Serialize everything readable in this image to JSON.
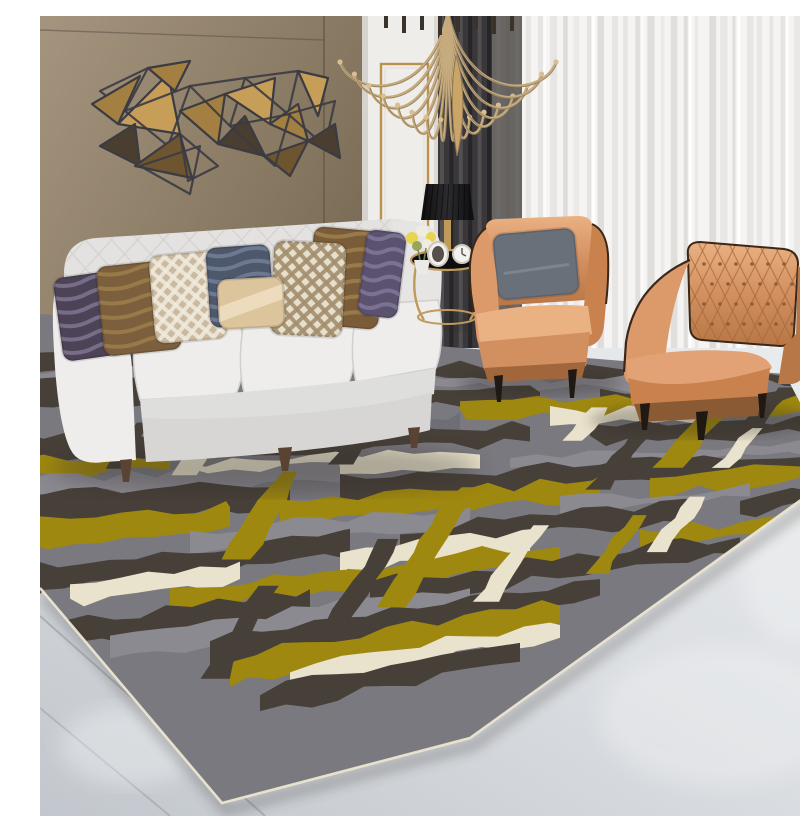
{
  "scene": {
    "description": "modern living room photo: white tufted sofa, two tan leather armchairs, gold geometric wall art on brown wall, sheer curtains, abstract gray-olive-cream area rug on light tile floor",
    "palette": {
      "wall_top": "#9c8d78",
      "wall_bottom": "#6b5d4c",
      "wall_seam": "#5d5246",
      "wall_corner": "#43392e",
      "door_white": "#efedea",
      "door_shadow": "#d6d2ce",
      "gold": "#b8924e",
      "curtain_dark": "#39373a",
      "curtain_dark_fold": "#232225",
      "curtain_dark_lite": "#575456",
      "curtain_gray": "#716d6b",
      "sheer": "#f5f4f2",
      "sheer_fold": "#d2d0ce",
      "sheer_bright": "#ffffff",
      "floor_light": "#e7e9ec",
      "floor_dark": "#c4c9cf",
      "grout": "#a6aaaf",
      "rug_base": "#7a797f",
      "rug_gray2": "#8b8a91",
      "rug_patch": "#6f6e75",
      "rug_dark": "#474039",
      "rug_olive": "#9f880f",
      "rug_cream": "#e9e2cc",
      "rug_edge": "#ece5d0",
      "sofa_body": "#e3e2e1",
      "sofa_lite": "#eeedec",
      "sofa_front": "#dededd",
      "sofa_skirt": "#d7d6d5",
      "sofa_tuft": "#d3d2d1",
      "leg_wood": "#5a4332",
      "leather": "#d08c5c",
      "leather_lite": "#eab183",
      "leather_mid": "#c9824e",
      "leather_dark": "#a2663c",
      "piping": "#3a2718",
      "leg_black": "#1f1813",
      "lamp_black": "#1a191b",
      "metal_gold": "#c09a5a",
      "art_wire": "#3b3b42",
      "art_gold": "#c79e58",
      "art_gold2": "#a37f42",
      "art_bronze": "#6e5530",
      "art_dark": "#4a3e31",
      "shadow": "#2e2b28"
    }
  },
  "chandelier": {
    "cx": 408,
    "arm_count": 16,
    "x_min": 300,
    "x_max": 516,
    "tip_top": 46,
    "tip_drop": 58,
    "candle_count": 8
  },
  "wall_art": {
    "triangles": [
      {
        "p": [
          [
            60,
            75
          ],
          [
            108,
            52
          ],
          [
            85,
            95
          ]
        ],
        "k": "wire"
      },
      {
        "p": [
          [
            52,
            88
          ],
          [
            100,
            60
          ],
          [
            78,
            108
          ]
        ],
        "k": "gold2"
      },
      {
        "p": [
          [
            78,
            108
          ],
          [
            128,
            58
          ],
          [
            140,
            118
          ]
        ],
        "k": "gold"
      },
      {
        "p": [
          [
            85,
            95
          ],
          [
            150,
            70
          ],
          [
            128,
            130
          ]
        ],
        "k": "wire"
      },
      {
        "p": [
          [
            60,
            130
          ],
          [
            95,
            108
          ],
          [
            100,
            150
          ]
        ],
        "k": "dark"
      },
      {
        "p": [
          [
            95,
            150
          ],
          [
            140,
            118
          ],
          [
            152,
            162
          ]
        ],
        "k": "bronze"
      },
      {
        "p": [
          [
            100,
            150
          ],
          [
            160,
            130
          ],
          [
            150,
            178
          ]
        ],
        "k": "wire"
      },
      {
        "p": [
          [
            140,
            95
          ],
          [
            185,
            78
          ],
          [
            178,
            128
          ]
        ],
        "k": "gold2"
      },
      {
        "p": [
          [
            150,
            70
          ],
          [
            205,
            62
          ],
          [
            190,
            110
          ]
        ],
        "k": "wire"
      },
      {
        "p": [
          [
            178,
            128
          ],
          [
            205,
            100
          ],
          [
            225,
            140
          ]
        ],
        "k": "dark"
      },
      {
        "p": [
          [
            185,
            78
          ],
          [
            235,
            62
          ],
          [
            230,
            108
          ]
        ],
        "k": "gold"
      },
      {
        "p": [
          [
            205,
            62
          ],
          [
            258,
            55
          ],
          [
            248,
            98
          ]
        ],
        "k": "wire"
      },
      {
        "p": [
          [
            230,
            108
          ],
          [
            258,
            88
          ],
          [
            268,
            125
          ]
        ],
        "k": "gold2"
      },
      {
        "p": [
          [
            225,
            140
          ],
          [
            268,
            125
          ],
          [
            250,
            160
          ]
        ],
        "k": "bronze"
      },
      {
        "p": [
          [
            190,
            110
          ],
          [
            250,
            98
          ],
          [
            235,
            150
          ]
        ],
        "k": "wire"
      },
      {
        "p": [
          [
            258,
            55
          ],
          [
            288,
            62
          ],
          [
            278,
            100
          ]
        ],
        "k": "gold"
      },
      {
        "p": [
          [
            248,
            98
          ],
          [
            295,
            85
          ],
          [
            285,
            130
          ]
        ],
        "k": "wire"
      },
      {
        "p": [
          [
            268,
            125
          ],
          [
            295,
            108
          ],
          [
            300,
            142
          ]
        ],
        "k": "dark"
      },
      {
        "p": [
          [
            140,
            118
          ],
          [
            178,
            150
          ],
          [
            148,
            165
          ]
        ],
        "k": "wire"
      },
      {
        "p": [
          [
            108,
            52
          ],
          [
            150,
            45
          ],
          [
            135,
            75
          ]
        ],
        "k": "gold2"
      }
    ]
  },
  "rug": {
    "outline": [
      [
        -100,
        290
      ],
      [
        745,
        358
      ],
      [
        797,
        458
      ],
      [
        430,
        722
      ],
      [
        182,
        787
      ],
      [
        0,
        572
      ],
      [
        -100,
        460
      ]
    ],
    "edge_path": [
      [
        797,
        458
      ],
      [
        430,
        722
      ],
      [
        182,
        787
      ],
      [
        0,
        572
      ]
    ],
    "vanish_x": 1733,
    "vanish_y": 384,
    "lean": 0.55,
    "stripes": [
      {
        "y0": 336,
        "y1": 352,
        "c": "rug_dark",
        "segs": [
          [
            -100,
            770
          ]
        ]
      },
      {
        "y0": 352,
        "y1": 366,
        "c": "rug_gray2",
        "segs": [
          [
            -100,
            290
          ],
          [
            380,
            700
          ]
        ]
      },
      {
        "y0": 366,
        "y1": 388,
        "c": "rug_dark",
        "segs": [
          [
            -100,
            170
          ],
          [
            230,
            500
          ],
          [
            560,
            790
          ]
        ]
      },
      {
        "y0": 382,
        "y1": 404,
        "c": "rug_olive",
        "segs": [
          [
            140,
            300
          ],
          [
            420,
            790
          ]
        ]
      },
      {
        "y0": 400,
        "y1": 420,
        "c": "rug_cream",
        "segs": [
          [
            110,
            190
          ],
          [
            510,
            660
          ]
        ]
      },
      {
        "y0": 404,
        "y1": 426,
        "c": "rug_patch",
        "segs": [
          [
            200,
            420
          ]
        ]
      },
      {
        "y0": 420,
        "y1": 444,
        "c": "rug_dark",
        "segs": [
          [
            -100,
            490
          ],
          [
            550,
            800
          ]
        ]
      },
      {
        "y0": 442,
        "y1": 460,
        "c": "rug_olive",
        "segs": [
          [
            -100,
            130
          ]
        ]
      },
      {
        "y0": 452,
        "y1": 472,
        "c": "rug_cream",
        "segs": [
          [
            140,
            440
          ]
        ]
      },
      {
        "y0": 462,
        "y1": 482,
        "c": "rug_gray2",
        "segs": [
          [
            -40,
            300
          ],
          [
            470,
            800
          ]
        ]
      },
      {
        "y0": 480,
        "y1": 506,
        "c": "rug_dark",
        "segs": [
          [
            -100,
            250
          ],
          [
            300,
            810
          ]
        ]
      },
      {
        "y0": 502,
        "y1": 530,
        "c": "rug_olive",
        "segs": [
          [
            -100,
            190
          ],
          [
            240,
            560
          ],
          [
            610,
            815
          ]
        ]
      },
      {
        "y0": 528,
        "y1": 550,
        "c": "rug_gray2",
        "segs": [
          [
            150,
            430
          ],
          [
            520,
            710
          ]
        ]
      },
      {
        "y0": 548,
        "y1": 574,
        "c": "rug_dark",
        "segs": [
          [
            -60,
            310
          ],
          [
            360,
            650
          ],
          [
            700,
            820
          ]
        ]
      },
      {
        "y0": 568,
        "y1": 592,
        "c": "rug_cream",
        "segs": [
          [
            30,
            200
          ],
          [
            300,
            490
          ]
        ]
      },
      {
        "y0": 588,
        "y1": 614,
        "c": "rug_olive",
        "segs": [
          [
            130,
            520
          ],
          [
            600,
            770
          ]
        ]
      },
      {
        "y0": 610,
        "y1": 636,
        "c": "rug_dark",
        "segs": [
          [
            -30,
            270
          ],
          [
            330,
            700
          ]
        ]
      },
      {
        "y0": 630,
        "y1": 654,
        "c": "rug_gray2",
        "segs": [
          [
            70,
            430
          ]
        ]
      },
      {
        "y0": 650,
        "y1": 680,
        "c": "rug_dark",
        "segs": [
          [
            170,
            560
          ]
        ]
      },
      {
        "y0": 672,
        "y1": 705,
        "c": "rug_olive",
        "segs": [
          [
            190,
            520
          ]
        ]
      },
      {
        "y0": 698,
        "y1": 722,
        "c": "rug_cream",
        "segs": [
          [
            -40,
            90
          ],
          [
            250,
            520
          ]
        ]
      },
      {
        "y0": 716,
        "y1": 742,
        "c": "rug_dark",
        "segs": [
          [
            220,
            480
          ]
        ]
      }
    ],
    "crosses": [
      {
        "x": 170,
        "a": 418,
        "b": 468,
        "w": 16,
        "c": "rug_cream"
      },
      {
        "x": 250,
        "a": 468,
        "b": 565,
        "w": 20,
        "c": "rug_olive"
      },
      {
        "x": 335,
        "a": 398,
        "b": 470,
        "w": 15,
        "c": "rug_dark"
      },
      {
        "x": 430,
        "a": 500,
        "b": 645,
        "w": 22,
        "c": "rug_olive"
      },
      {
        "x": 560,
        "a": 395,
        "b": 448,
        "w": 16,
        "c": "rug_cream"
      },
      {
        "x": 610,
        "a": 420,
        "b": 525,
        "w": 17,
        "c": "rug_dark"
      },
      {
        "x": 688,
        "a": 378,
        "b": 505,
        "w": 22,
        "c": "rug_olive"
      },
      {
        "x": 748,
        "a": 362,
        "b": 432,
        "w": 14,
        "c": "rug_dark"
      },
      {
        "x": 500,
        "a": 560,
        "b": 662,
        "w": 16,
        "c": "rug_cream"
      },
      {
        "x": 103,
        "a": 408,
        "b": 456,
        "w": 13,
        "c": "rug_dark"
      },
      {
        "x": 350,
        "a": 558,
        "b": 682,
        "w": 18,
        "c": "rug_dark"
      },
      {
        "x": 718,
        "a": 432,
        "b": 500,
        "w": 13,
        "c": "rug_cream"
      },
      {
        "x": 660,
        "a": 540,
        "b": 622,
        "w": 15,
        "c": "rug_cream"
      },
      {
        "x": 228,
        "a": 598,
        "b": 705,
        "w": 18,
        "c": "rug_dark"
      },
      {
        "x": 600,
        "a": 560,
        "b": 640,
        "w": 14,
        "c": "rug_olive"
      }
    ]
  },
  "pillows": [
    {
      "x": 18,
      "y": 258,
      "w": 64,
      "h": 84,
      "rot": -8,
      "base": "#4d4356",
      "deco": "#8d84a2",
      "type": "snake"
    },
    {
      "x": 60,
      "y": 247,
      "w": 78,
      "h": 90,
      "rot": -6,
      "base": "#7c5f3d",
      "deco": "#a8874e",
      "type": "snake"
    },
    {
      "x": 112,
      "y": 237,
      "w": 72,
      "h": 88,
      "rot": -5,
      "base": "#cbbaa0",
      "deco": "#efe9da",
      "type": "trellis"
    },
    {
      "x": 168,
      "y": 230,
      "w": 64,
      "h": 80,
      "rot": -4,
      "base": "#4e586d",
      "deco": "#7e8aa4",
      "type": "snake"
    },
    {
      "x": 270,
      "y": 213,
      "w": 72,
      "h": 98,
      "rot": 5,
      "base": "#7b5c39",
      "deco": "#a98a54",
      "type": "snake"
    },
    {
      "x": 322,
      "y": 215,
      "w": 40,
      "h": 86,
      "rot": 7,
      "base": "#5b5270",
      "deco": "#8d84a6",
      "type": "snake"
    },
    {
      "x": 232,
      "y": 226,
      "w": 72,
      "h": 94,
      "rot": 3,
      "base": "#e6dfcb",
      "deco": "#a3906f",
      "type": "trellis"
    },
    {
      "x": 178,
      "y": 262,
      "w": 66,
      "h": 50,
      "rot": -3,
      "base": "#dcc49c",
      "deco": "#f2e6cb",
      "type": "satin"
    }
  ],
  "chair_pillow": {
    "x": 455,
    "y": 215,
    "w": 82,
    "h": 66,
    "rot": -5,
    "base": "#69707a",
    "deco": "#828a94"
  }
}
